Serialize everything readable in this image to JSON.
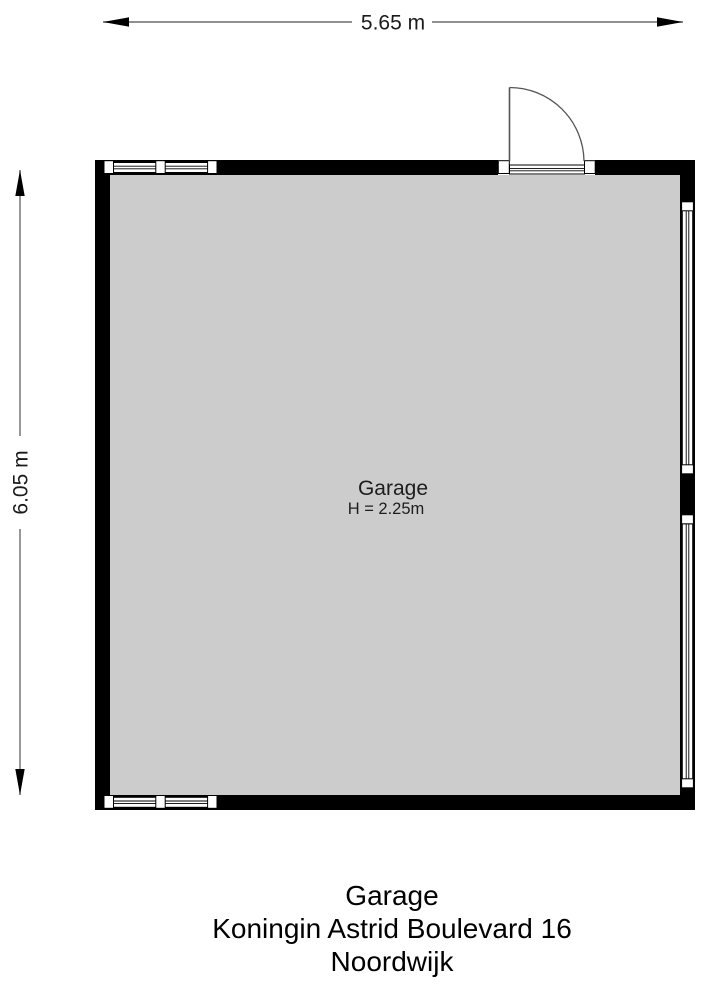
{
  "page": {
    "type": "floorplan",
    "background": "#ffffff"
  },
  "dimensions": {
    "width_label": "5.65 m",
    "height_label": "6.05 m"
  },
  "room": {
    "name": "Garage",
    "height_label": "H = 2.25m"
  },
  "caption": {
    "title": "Garage",
    "address": "Koningin Astrid Boulevard 16",
    "city": "Noordwijk"
  },
  "colors": {
    "wall": "#000000",
    "floor": "#cccccc",
    "dimension_line": "#6b6b6b",
    "door_line": "#555555",
    "text": "#1a1a1a"
  },
  "features": {
    "windows": [
      "top-wall-window",
      "bottom-wall-window",
      "right-wall-window-upper",
      "right-wall-window-lower"
    ],
    "doors": [
      "top-wall-entry-door"
    ]
  }
}
